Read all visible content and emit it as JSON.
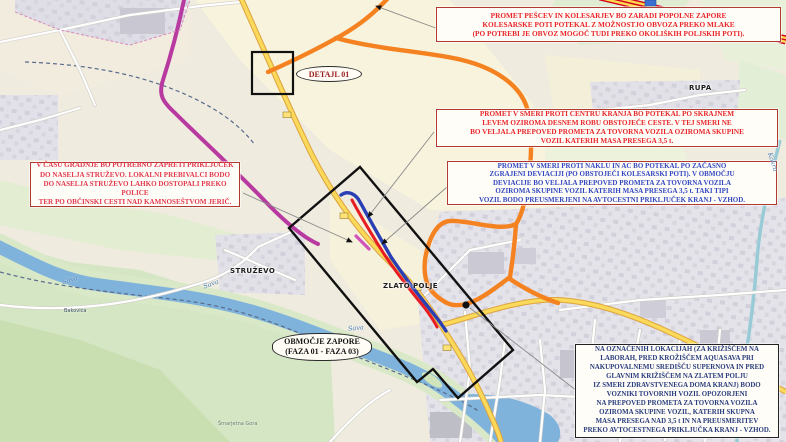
{
  "annotations": {
    "pedestrian_box": "PROMET PEŠCEV IN KOLESARJEV BO ZARADI POPOLNE ZAPORE\nKOLESARSKE POTI POTEKAL Z MOŽNOSTJO OBVOZA PREKO MLAKE\n(PO POTREBI JE OBVOZ MOGOČ TUDI PREKO OKOLIŠKIH POLJSKIH POTI).",
    "center_direction_box": "PROMET V SMERI PROTI CENTRU KRANJA BO POTEKAL PO SKRAJNEM\nLEVEM OZIROMA DESNEM ROBU OBSTOJEČE CESTE. V TEJ SMERI NE\nBO VELJALA PREPOVED PROMETA ZA TOVORNA VOZILA OZIROMA SKUPINE\nVOZIL KATERIH MASA PRESEGA 3,5 t.",
    "naklo_direction_box": "PROMET V SMERI PROTI NAKLU IN AC BO POTEKAL PO ZAČASNO\nZGRAJENI DEVIACIJI (PO OBSTOJEČI KOLESARSKI POTI). V OBMOČJU\nDEVIACIJE BO VELJALA PREPOVED PROMETA ZA TOVORNA VOZILA\nOZIROMA SKUPINE VOZIL KATERIH MASA PRESEGA 3,5 t. TAKI TIPI\nVOZIL BODO PREUSMERJENI NA AVTOCESTNI PRIKLJUČEK KRANJ - VZHOD.",
    "struzevo_box": "V ČASU GRADNJE BO POTREBNO ZAPRETI PRIKLJUČEK\nDO NASELJA STRUŽEVO. LOKALNI PREBIVALCI BODO\nDO NASELJA STRUŽEVO LAHKO DOSTOPALI PREKO POLICE\nTER PO OBČINSKI CESTI NAD KAMNOSEŠTVOM JERIČ.",
    "locations_box": "NA OZNAČENIH LOKACIJAH (ZA KRIŽIŠČEM NA\nLABORAH, PRED KROŽIŠČEM AQUASAVA PRI\nNAKUPOVALNEMU SREDIŠČU SUPERNOVA IN PRED\nGLAVNIM KRIŽIŠČEM NA ZLATEM POLJU\nIZ SMERI ZDRAVSTVENEGA DOMA KRANJ) BODO\nVOZNIKI TOVORNIH VOZIL OPOZORJENI\nNA PREPOVED PROMETA ZA TOVORNA VOZILA\nOZIROMA SKUPINE VOZIL, KATERIH SKUPNA\nMASA PRESEGA NAD 3,5 t IN NA PREUSMERITEV\nPREKO AVTOCESTNEGA PRIKLJUČKA KRANJ - VZHOD.",
    "detail_label": "DETAJL 01",
    "closure_area_label": "OBMOČJE ZAPORE\n(FAZA 01 - FAZA 03)"
  },
  "map_labels": {
    "struzevo": "STRUŽEVO",
    "zlato_polje": "ZLATO POLJE",
    "rupa": "RUPA",
    "sava": "Sava",
    "kokra": "Kokra",
    "smarjetna_gora": "Šmarjetna Gora",
    "bakovica": "Bakovica"
  },
  "colors": {
    "closure_outline": "#111111",
    "detour_orange": "#f58220",
    "deviation_red": "#e81c23",
    "deviation_blue": "#2b3fb4",
    "route_magenta": "#b83aa0",
    "warning_red_text": "#e8262b",
    "info_blue_text": "#3348c0",
    "navy_text": "#2a3d7c",
    "water_blue": "#7fb3db"
  }
}
